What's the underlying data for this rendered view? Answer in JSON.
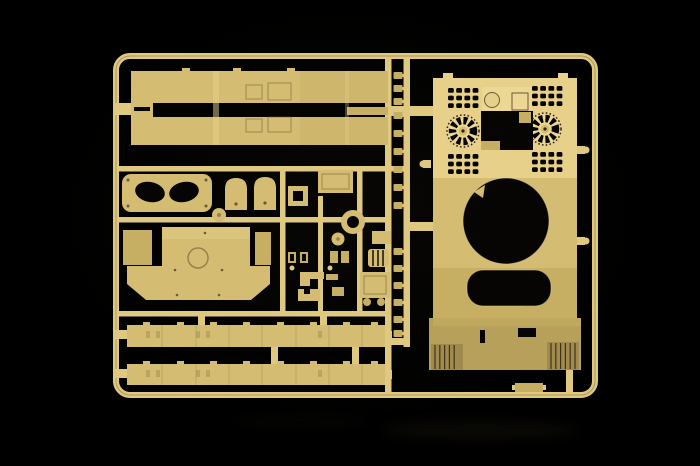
{
  "meta": {
    "alt": "Photograph of a tan injection-molded model kit sprue on a black background: a rectangular runner frame holding a tank hull-roof piece with fan and louvre grilles and a round turret-ring opening, two long side-skirt panels, two side-skirt strips, hatch plates, a ring part and many small detail parts",
    "width": 700,
    "height": 466
  },
  "colors": {
    "background": "#000000",
    "runner": "#dfc981",
    "plastic": "#d4bd72",
    "plastic_light": "#e6d08a",
    "plastic_lighter": "#ecd794",
    "plastic_mid": "#c6ae63",
    "plastic_dark": "#b7a05a",
    "plastic_deep": "#a18a4e",
    "hole": "#070503",
    "detail_line": "#6d5a33",
    "rib_line": "#2e2410",
    "shadow_glow": "#14120c"
  },
  "sprue": {
    "parts": [
      {
        "name": "sprue-frame"
      },
      {
        "name": "side-skirt-panel-upper"
      },
      {
        "name": "side-skirt-panel-lower"
      },
      {
        "name": "engine-hatch-plate"
      },
      {
        "name": "crew-hatch-left"
      },
      {
        "name": "crew-hatch-right"
      },
      {
        "name": "square-frame-part"
      },
      {
        "name": "ring-part"
      },
      {
        "name": "hull-roof-part"
      },
      {
        "name": "rear-deck-part"
      },
      {
        "name": "side-skirt-strip-upper"
      },
      {
        "name": "side-skirt-strip-lower"
      },
      {
        "name": "tiny-clamp-parts"
      },
      {
        "name": "small-detail-parts"
      }
    ]
  }
}
